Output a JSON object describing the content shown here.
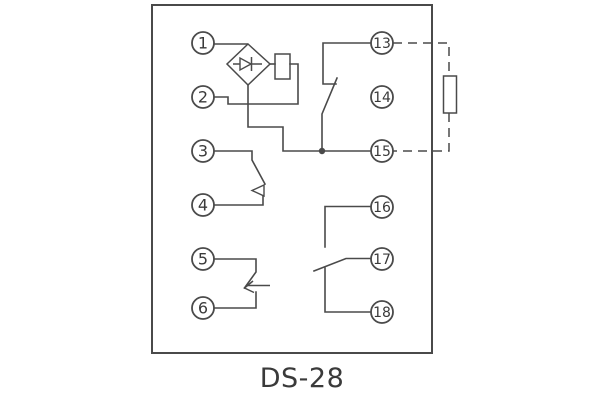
{
  "diagram": {
    "title": "DS-28",
    "palette": {
      "line": "#4a4a4a",
      "text": "#3a3a3a",
      "background": "#ffffff"
    },
    "terminals": {
      "left": [
        "1",
        "2",
        "3",
        "4",
        "5",
        "6"
      ],
      "right": [
        "13",
        "14",
        "15",
        "16",
        "17",
        "18"
      ]
    },
    "components": [
      "bridge-rectifier",
      "diode",
      "relay-coil",
      "external-resistor",
      "junction-dot",
      "contact-3-4",
      "contact-5-6",
      "contact-13-15",
      "contact-16-17-18"
    ]
  }
}
